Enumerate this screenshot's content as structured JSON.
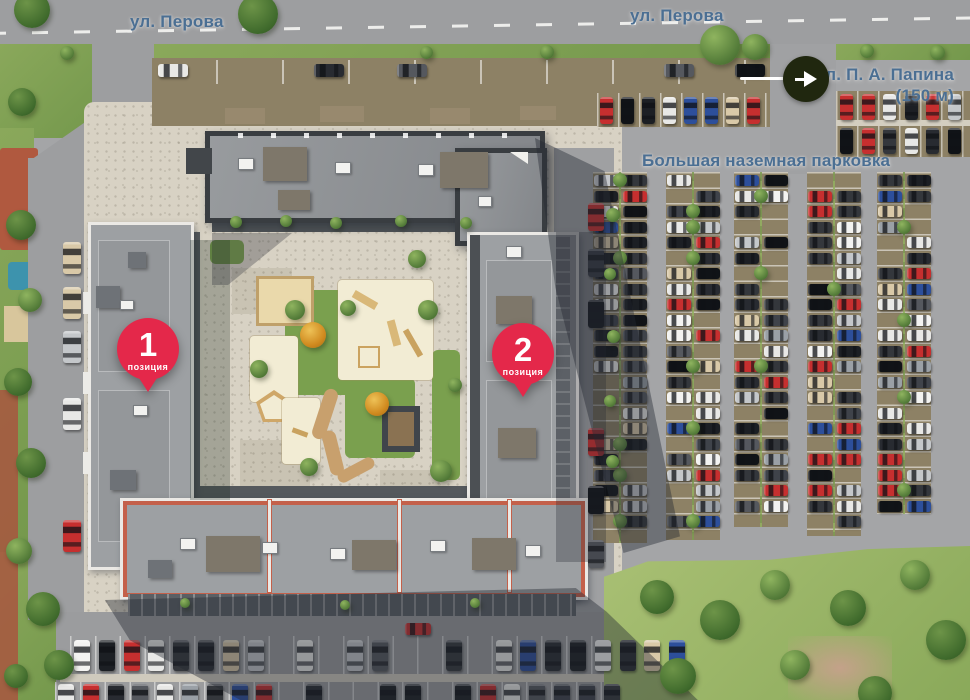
{
  "labels": {
    "street_perova_left": "ул. Перова",
    "street_perova_right": "ул. Перова",
    "street_papina_name": "ул. П. А. Папина",
    "street_papina_distance": "(150 м)",
    "big_parking": "Большая наземная парковка"
  },
  "markers": [
    {
      "number": "1",
      "caption": "позиция"
    },
    {
      "number": "2",
      "caption": "позиция"
    }
  ],
  "arrow": {
    "direction": "right"
  },
  "colors": {
    "label_text": "#4b6f93",
    "marker_red": "#e4284a",
    "arrow_circle_bg": "#20270f",
    "road": "#9d9ea0",
    "pavement": "#d8d2c4",
    "stall_brown": "#8d8165",
    "grass": "#7fa052",
    "meadow": "#9cb96b",
    "roof_light": "#9da0a3",
    "roof_dark": "#8f9295",
    "roof_dark_border": "#393d41",
    "parapet_white": "#ebe9e5",
    "trim_red": "#c4604a",
    "shadow": "rgba(36,41,51,0.42)",
    "car_palette": [
      "#34373c",
      "#1c1f24",
      "#101317",
      "#e8e8e6",
      "#f3f3f1",
      "#c4c7ca",
      "#9aa0a6",
      "#34373c",
      "#c62f2f",
      "#2d4f9b",
      "#d9c9a8",
      "#55585e",
      "#e8e8e6",
      "#282b31",
      "#3f434a",
      "#c62f2f"
    ]
  },
  "scene": {
    "seed": 13,
    "occupancy": 0.8,
    "big_lot": {
      "col_width": 54,
      "stall_h": 15.5,
      "columns": [
        {
          "x": 620,
          "top": 172,
          "bottom": 543
        },
        {
          "x": 693,
          "top": 172,
          "bottom": 540
        },
        {
          "x": 761,
          "top": 172,
          "bottom": 527
        },
        {
          "x": 834,
          "top": 172,
          "bottom": 536
        },
        {
          "x": 904,
          "top": 172,
          "bottom": 514
        }
      ]
    }
  }
}
